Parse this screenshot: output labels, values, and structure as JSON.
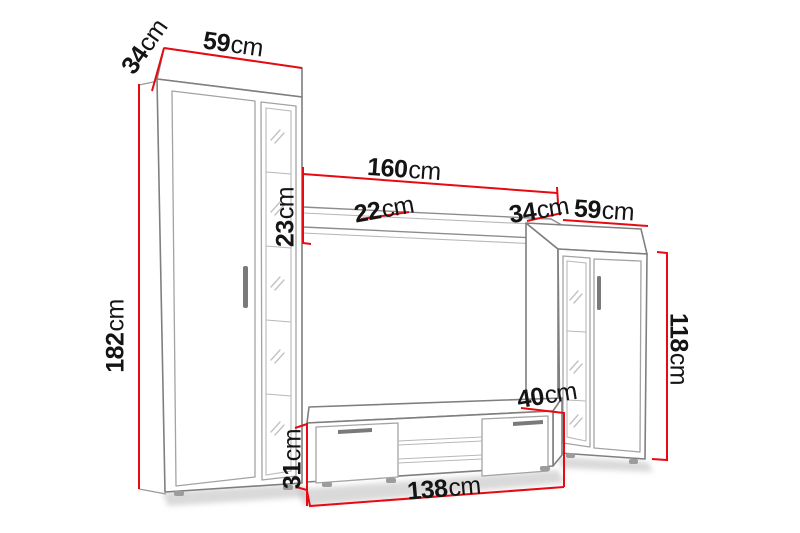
{
  "diagram": {
    "kind": "furniture-dimension-diagram",
    "subject": "tv-wall-unit"
  },
  "dimensions": {
    "left_cabinet_depth": {
      "value": "34",
      "unit": "cm"
    },
    "left_cabinet_width": {
      "value": "59",
      "unit": "cm"
    },
    "left_cabinet_height": {
      "value": "182",
      "unit": "cm"
    },
    "shelf_width": {
      "value": "160",
      "unit": "cm"
    },
    "shelf_height": {
      "value": "23",
      "unit": "cm"
    },
    "shelf_depth": {
      "value": "22",
      "unit": "cm"
    },
    "right_cabinet_depth": {
      "value": "34",
      "unit": "cm"
    },
    "right_cabinet_width": {
      "value": "59",
      "unit": "cm"
    },
    "right_cabinet_height": {
      "value": "118",
      "unit": "cm"
    },
    "tv_stand_depth": {
      "value": "40",
      "unit": "cm"
    },
    "tv_stand_height": {
      "value": "31",
      "unit": "cm"
    },
    "tv_stand_width": {
      "value": "138",
      "unit": "cm"
    }
  },
  "colors": {
    "dimension_red": "#e60b12",
    "furniture_gray": "#7f7f7f",
    "background": "#ffffff",
    "label_text": "#141414"
  }
}
